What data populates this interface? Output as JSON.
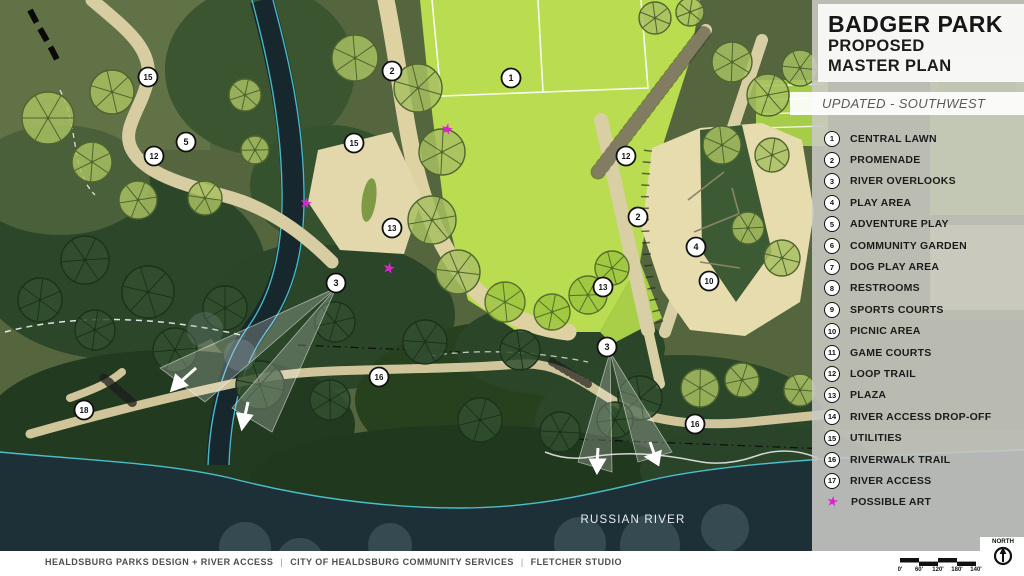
{
  "title_block": {
    "title": "BADGER PARK",
    "subtitle_line1": "PROPOSED",
    "subtitle_line2": "MASTER PLAN",
    "update_note": "UPDATED - SOUTHWEST"
  },
  "legend": {
    "items": [
      {
        "num": "1",
        "label": "CENTRAL LAWN"
      },
      {
        "num": "2",
        "label": "PROMENADE"
      },
      {
        "num": "3",
        "label": "RIVER OVERLOOKS"
      },
      {
        "num": "4",
        "label": "PLAY AREA"
      },
      {
        "num": "5",
        "label": "ADVENTURE PLAY"
      },
      {
        "num": "6",
        "label": "COMMUNITY GARDEN"
      },
      {
        "num": "7",
        "label": "DOG PLAY AREA"
      },
      {
        "num": "8",
        "label": "RESTROOMS"
      },
      {
        "num": "9",
        "label": "SPORTS COURTS"
      },
      {
        "num": "10",
        "label": "PICNIC AREA"
      },
      {
        "num": "11",
        "label": "GAME COURTS"
      },
      {
        "num": "12",
        "label": "LOOP TRAIL"
      },
      {
        "num": "13",
        "label": "PLAZA"
      },
      {
        "num": "14",
        "label": "RIVER ACCESS DROP-OFF"
      },
      {
        "num": "15",
        "label": "UTILITIES"
      },
      {
        "num": "16",
        "label": "RIVERWALK TRAIL"
      },
      {
        "num": "17",
        "label": "RIVER ACCESS"
      }
    ],
    "art_item": {
      "label": "POSSIBLE ART",
      "symbol": "star"
    }
  },
  "map": {
    "river_label": "RUSSIAN RIVER",
    "markers": [
      {
        "n": "15",
        "x": 148,
        "y": 77
      },
      {
        "n": "5",
        "x": 186,
        "y": 142
      },
      {
        "n": "12",
        "x": 154,
        "y": 156
      },
      {
        "n": "2",
        "x": 392,
        "y": 71
      },
      {
        "n": "1",
        "x": 511,
        "y": 78
      },
      {
        "n": "15",
        "x": 354,
        "y": 143
      },
      {
        "n": "13",
        "x": 392,
        "y": 228
      },
      {
        "n": "12",
        "x": 626,
        "y": 156
      },
      {
        "n": "2",
        "x": 638,
        "y": 217
      },
      {
        "n": "4",
        "x": 696,
        "y": 247
      },
      {
        "n": "10",
        "x": 709,
        "y": 281
      },
      {
        "n": "13",
        "x": 603,
        "y": 287
      },
      {
        "n": "3",
        "x": 336,
        "y": 283
      },
      {
        "n": "3",
        "x": 607,
        "y": 347
      },
      {
        "n": "16",
        "x": 379,
        "y": 377
      },
      {
        "n": "16",
        "x": 695,
        "y": 424
      },
      {
        "n": "18",
        "x": 84,
        "y": 410
      }
    ],
    "art_stars": [
      {
        "x": 447,
        "y": 129
      },
      {
        "x": 306,
        "y": 203
      },
      {
        "x": 389,
        "y": 268
      }
    ]
  },
  "footer": {
    "credits": [
      "HEALDSBURG PARKS DESIGN + RIVER ACCESS",
      "CITY OF HEALDSBURG COMMUNITY SERVICES",
      "FLETCHER STUDIO"
    ],
    "scale_labels": [
      "0'",
      "60'",
      "120'",
      "180'",
      "140'"
    ],
    "north_label": "NORTH"
  },
  "colors": {
    "art_accent": "#df22d2",
    "lawn_green": "#b9dc50",
    "path_tan": "#dcd1a4",
    "river_dark": "#1d3038",
    "shore_cyan": "#4ec6d6"
  }
}
